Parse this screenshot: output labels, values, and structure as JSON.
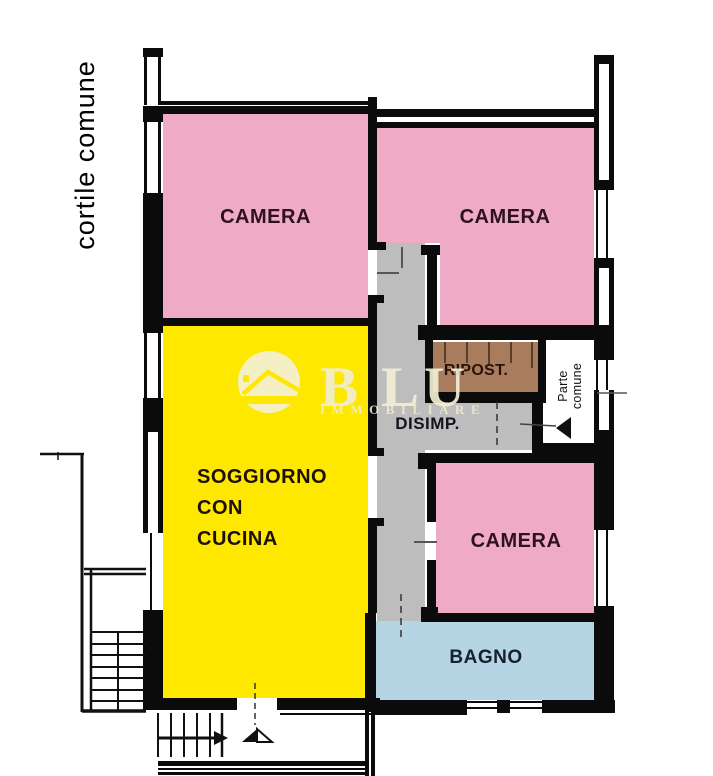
{
  "plan": {
    "courtyard_label": "cortile comune",
    "rooms": {
      "camera_top_left": "CAMERA",
      "camera_top_right": "CAMERA",
      "camera_bottom": "CAMERA",
      "soggiorno": [
        "SOGGIORNO",
        "CON",
        "CUCINA"
      ],
      "disimpegno": "DISIMP.",
      "ripostiglio": "RIPOST.",
      "bagno": "BAGNO"
    },
    "common_area_label": [
      "Parte",
      "comune"
    ],
    "watermark": {
      "letters": [
        "B",
        "L",
        "U"
      ],
      "subtitle": "IMMOBILIARE"
    },
    "colors": {
      "bedroom_pink": "#EFAAC5",
      "living_yellow": "#FFE800",
      "hallway_gray": "#BDBDBD",
      "storage_brown": "#A87C5C",
      "bath_blue": "#B5D5E5",
      "wall_black": "#0B0B0B",
      "watermark_cream": "#F2EFCB",
      "camera_text": "#2E1220"
    }
  }
}
